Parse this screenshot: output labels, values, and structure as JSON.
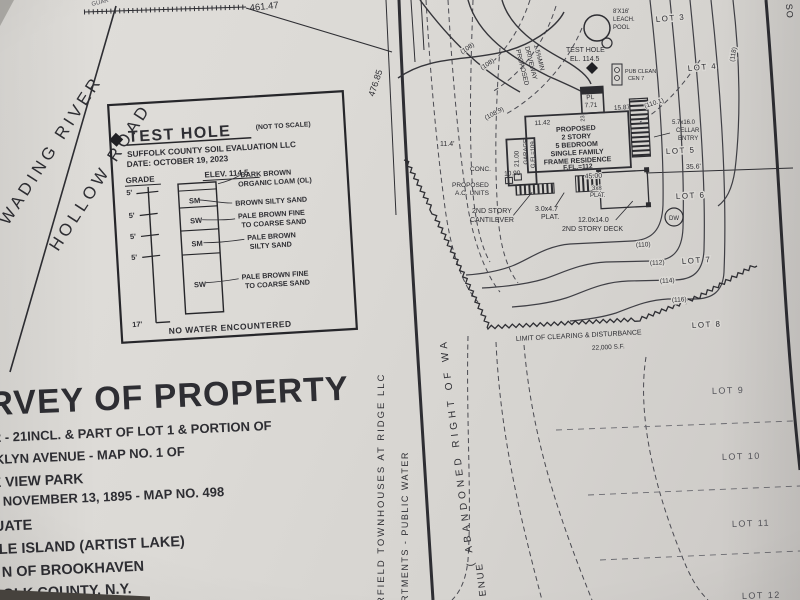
{
  "roads": {
    "wading": "WADING RIVER",
    "hollow": "HOLLOW ROAD",
    "corner_so": "SO",
    "guar": "GUAR",
    "avenue": "ENUE",
    "abandoned": "( ABANDONED  RIGHT  OF  WA"
  },
  "boundaries": {
    "top_dim": "461.47",
    "left_dim": "476.85",
    "lot5_dim": "35.6'"
  },
  "margin": {
    "townhouses": "RFIELD TOWNHOUSES AT RIDGE LLC",
    "apartments": "RTMENTS - PUBLIC WATER"
  },
  "test_hole_box": {
    "title": "TEST HOLE",
    "not_to_scale": "(NOT TO SCALE)",
    "firm": "SUFFOLK COUNTY SOIL EVALUATION LLC",
    "date": "DATE: OCTOBER 19, 2023",
    "grade_label": "GRADE",
    "elev_label": "ELEV. 114.5",
    "depths": [
      "5'",
      "5'",
      "5'",
      "5'"
    ],
    "bottom_depth": "17'",
    "layers": [
      {
        "code": "",
        "line1": "DARK BROWN",
        "line2": "ORGANIC LOAM (OL)"
      },
      {
        "code": "SM",
        "line1": "BROWN SILTY SAND",
        "line2": ""
      },
      {
        "code": "SW",
        "line1": "PALE BROWN FINE",
        "line2": "TO COARSE SAND"
      },
      {
        "code": "SM",
        "line1": "PALE BROWN",
        "line2": "SILTY SAND"
      },
      {
        "code": "SW",
        "line1": "PALE BROWN FINE",
        "line2": "TO COARSE SAND"
      }
    ],
    "footer": "NO WATER ENCOUNTERED"
  },
  "site": {
    "test_hole1": "TEST HOLE",
    "test_hole2": "EL. 114.5",
    "leach1": "8'X16'",
    "leach2": "LEACH.",
    "leach3": "POOL",
    "pub1": "PUB CLEAN",
    "pub2": "CEN 7",
    "drive1": "PROPOSED",
    "drive2": "DRIVEWAY",
    "drive3": "1.5%MIN",
    "conc": "CONC.",
    "ac1": "PROPOSED",
    "ac2": "A.C. UNITS",
    "cant1": "2ND STORY",
    "cant2": "CANTILEVER",
    "plat1": "3.0x4.7",
    "plat2": "PLAT.",
    "plat3x8a": "3x8",
    "plat3x8b": "PLAT.",
    "deck1": "12.0x14.0",
    "deck2": "2ND STORY DECK",
    "cellar1": "5.7x16.0",
    "cellar2": "CELLAR",
    "cellar3": "ENTRY",
    "dw": "DW",
    "clearing1": "LIMIT OF CLEARING & DISTURBANCE",
    "clearing2": "22,000 S.F.",
    "dim114": "11.4'"
  },
  "house": {
    "lines": [
      "PROPOSED",
      "2 STORY",
      "5 BEDROOM",
      "SINGLE FAMILY",
      "FRAME RESIDENCE",
      "F.FL.=112"
    ],
    "d45": "45.00",
    "d1142": "11.42",
    "d1587": "15.87",
    "pl": "PL",
    "d771": "7.71",
    "d23": "23",
    "d2100": "21.00",
    "garage": "GARAGE",
    "gfl": "G.FL=109",
    "d1090": "10.90"
  },
  "contours": {
    "c108a": "(108)",
    "c108b": "(108)",
    "c1089": "(108.9)",
    "c1101": "(110.1)",
    "c110": "(110)",
    "c112": "(112)",
    "c114": "(114)",
    "c116": "(116)",
    "c118": "(118)"
  },
  "lots": [
    "LOT 3",
    "LOT 4",
    "LOT 5",
    "LOT 6",
    "LOT 7",
    "LOT 8",
    "LOT 9",
    "LOT 10",
    "LOT 11",
    "LOT 12"
  ],
  "title_block": {
    "title": "RVEY OF PROPERTY",
    "lines": [
      "2 - 21INCL. & PART OF LOT 1 & PORTION OF",
      "KLYN AVENUE - MAP NO. 1 OF",
      "E VIEW PARK",
      "NOVEMBER 13, 1895 - MAP NO. 498",
      "UATE",
      "LE ISLAND (ARTIST LAKE)",
      "N OF BROOKHAVEN",
      "OLK COUNTY, N.Y."
    ]
  }
}
